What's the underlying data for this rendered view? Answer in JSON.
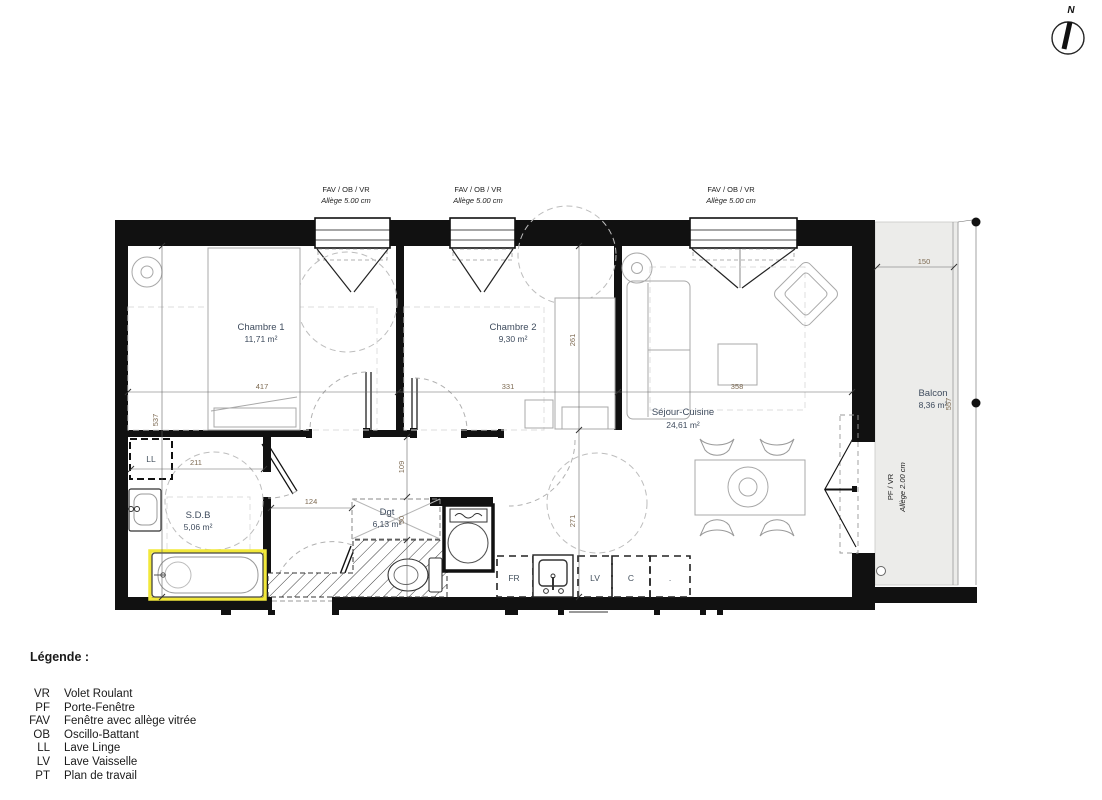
{
  "compass": {
    "north_label": "N"
  },
  "windows": {
    "type_label": "FAV / OB / VR",
    "allege_label": "Allège  5.00 cm"
  },
  "balcony_door": {
    "type_label": "PF / VR",
    "allege_label": "Allège  2.00 cm"
  },
  "rooms": {
    "chambre1": {
      "name": "Chambre 1",
      "area": "11,71 m²"
    },
    "chambre2": {
      "name": "Chambre 2",
      "area": "9,30 m²"
    },
    "sejour": {
      "name": "Séjour-Cuisine",
      "area": "24,61 m²"
    },
    "sdb": {
      "name": "S.D.B",
      "area": "5,06 m²"
    },
    "dgt": {
      "name": "Dgt",
      "area": "6,13 m²"
    },
    "balcon": {
      "name": "Balcon",
      "area": "8,36 m²"
    }
  },
  "fixtures": {
    "lave_linge": "LL",
    "refrigerateur": "FR",
    "lave_vaisselle": "LV",
    "cuisson": "C",
    "spare": "."
  },
  "dimensions": {
    "chambre1_width": "417",
    "chambre2_width": "331",
    "sejour_width": "358",
    "balcon_width": "150",
    "balcon_height": "557",
    "left_height": "537",
    "chambre2_depth": "261",
    "sejour_depth": "271",
    "sdb_width": "211",
    "hall_width": "124",
    "hall_height": "109",
    "dgt_depth": "50"
  },
  "legend": {
    "title": "Légende :",
    "items": [
      {
        "abbr": "VR",
        "label": "Volet Roulant"
      },
      {
        "abbr": "PF",
        "label": "Porte-Fenêtre"
      },
      {
        "abbr": "FAV",
        "label": "Fenêtre avec allège vitrée"
      },
      {
        "abbr": "OB",
        "label": "Oscillo-Battant"
      },
      {
        "abbr": "LL",
        "label": "Lave Linge"
      },
      {
        "abbr": "LV",
        "label": "Lave Vaisselle"
      },
      {
        "abbr": "PT",
        "label": "Plan de travail"
      }
    ]
  },
  "colors": {
    "wall": "#111111",
    "room_label": "#3f4c5e",
    "dimension_text": "#7d6a52",
    "balcony_fill": "#ececea",
    "tub_highlight": "#f2e83a",
    "furniture_line": "#a8a8a8"
  }
}
